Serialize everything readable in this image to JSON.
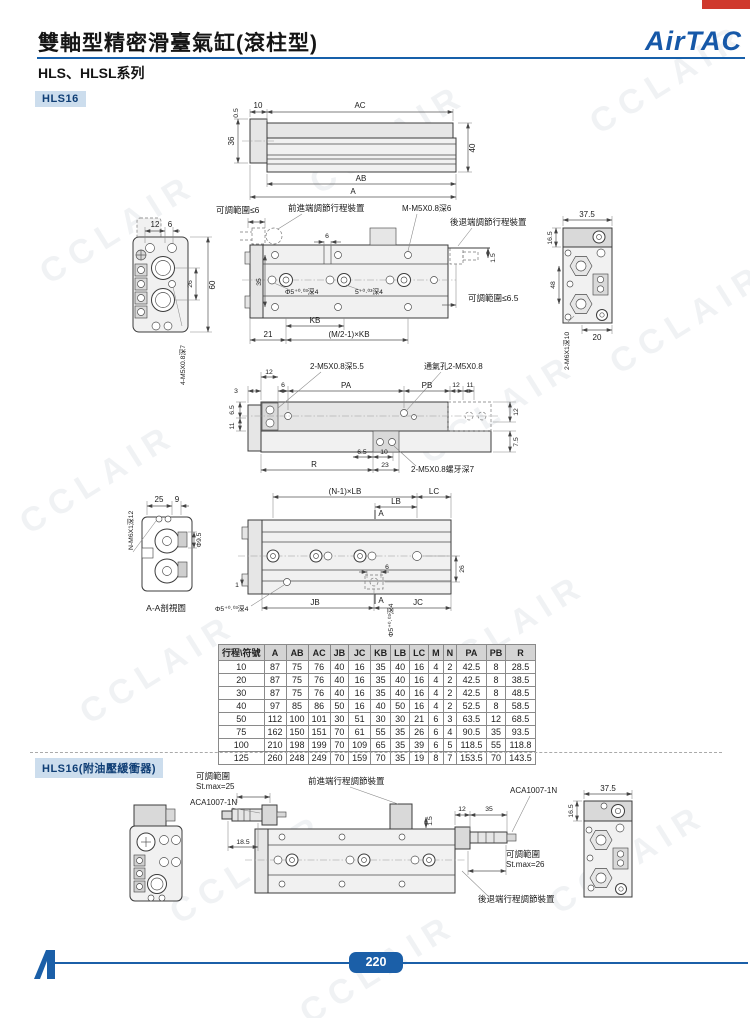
{
  "page": {
    "title": "雙軸型精密滑臺氣缸(滾柱型)",
    "series": "HLS、HLSL系列",
    "brand": "AirTAC",
    "page_number": "220",
    "watermark": "CCLAIR",
    "accent_blue": "#1b5fa8",
    "tab_red": "#cf3a2e"
  },
  "badges": {
    "model": "HLS16",
    "model_buffer": "HLS16(附油壓緩衝器)"
  },
  "d1": {
    "t05": "0.5",
    "t10": "10",
    "ac": "AC",
    "h36": "36",
    "h40": "40",
    "ab": "AB",
    "a": "A"
  },
  "d2": {
    "w12": "12",
    "w6": "6",
    "h26": "26",
    "h60": "60",
    "thread_left": "4-M5X0.8深7",
    "adj6": "可調範圍≤6",
    "front_dev": "前進端調節行程裝置",
    "m_thread": "M-M5X0.8深6",
    "rear_dev": "後退端調節行程裝置",
    "t6": "6",
    "h35": "35",
    "g15": "1.5",
    "hole1": "Φ5⁺⁰·⁰³深4",
    "hole2": "5⁺⁰·⁰³深4",
    "adj65": "可調範圍≤6.5",
    "kb": "KB",
    "n21": "21",
    "mkb": "(M/2-1)×KB",
    "w375": "37.5",
    "h165": "16.5",
    "h48": "48",
    "w20": "20",
    "thread_right": "2-M6X1深10"
  },
  "d3": {
    "thr_top": "2-M5X0.8深5.5",
    "vent": "通氣孔2-M5X0.8",
    "n3": "3",
    "n12": "12",
    "n6": "6",
    "pa": "PA",
    "pb": "PB",
    "n12b": "12",
    "n11": "11",
    "h65": "6.5",
    "h11": "11",
    "h12": "12",
    "h75": "7.5",
    "b65": "6.5",
    "b10": "10",
    "r": "R",
    "b23": "23",
    "thr_bottom": "2-M5X0.8螺牙深7"
  },
  "d4": {
    "n25": "25",
    "n9": "9",
    "dia95": "Φ9.5",
    "thread": "N-M6X1深12",
    "caption": "A-A剖視圖",
    "nlb": "(N-1)×LB",
    "lc": "LC",
    "lb": "LB",
    "a1": "A",
    "n6": "6",
    "n26": "26",
    "jb": "JB",
    "a2": "A",
    "jc": "JC",
    "hole": "Φ5⁺⁰·⁰³深4",
    "n1": "1"
  },
  "d5": {
    "adj": "可調範圍",
    "st25": "St.max=25",
    "aca_l": "ACA1007-1N",
    "front_dev": "前進端行程調節裝置",
    "aca_r": "ACA1007-1N",
    "n12": "12",
    "n35": "35",
    "g15": "1.5",
    "n185": "18.5",
    "adj2": "可調範圍",
    "st26": "St.max=26",
    "rear_dev": "後退端行程調節裝置",
    "w375": "37.5",
    "h165": "16.5"
  },
  "table": {
    "headers": [
      "行程\\符號",
      "A",
      "AB",
      "AC",
      "JB",
      "JC",
      "KB",
      "LB",
      "LC",
      "M",
      "N",
      "PA",
      "PB",
      "R"
    ],
    "rows": [
      [
        "10",
        "87",
        "75",
        "76",
        "40",
        "16",
        "35",
        "40",
        "16",
        "4",
        "2",
        "42.5",
        "8",
        "28.5"
      ],
      [
        "20",
        "87",
        "75",
        "76",
        "40",
        "16",
        "35",
        "40",
        "16",
        "4",
        "2",
        "42.5",
        "8",
        "38.5"
      ],
      [
        "30",
        "87",
        "75",
        "76",
        "40",
        "16",
        "35",
        "40",
        "16",
        "4",
        "2",
        "42.5",
        "8",
        "48.5"
      ],
      [
        "40",
        "97",
        "85",
        "86",
        "50",
        "16",
        "40",
        "50",
        "16",
        "4",
        "2",
        "52.5",
        "8",
        "58.5"
      ],
      [
        "50",
        "112",
        "100",
        "101",
        "30",
        "51",
        "30",
        "30",
        "21",
        "6",
        "3",
        "63.5",
        "12",
        "68.5"
      ],
      [
        "75",
        "162",
        "150",
        "151",
        "70",
        "61",
        "55",
        "35",
        "26",
        "6",
        "4",
        "90.5",
        "35",
        "93.5"
      ],
      [
        "100",
        "210",
        "198",
        "199",
        "70",
        "109",
        "65",
        "35",
        "39",
        "6",
        "5",
        "118.5",
        "55",
        "118.8"
      ],
      [
        "125",
        "260",
        "248",
        "249",
        "70",
        "159",
        "70",
        "35",
        "19",
        "8",
        "7",
        "153.5",
        "70",
        "143.5"
      ]
    ]
  }
}
